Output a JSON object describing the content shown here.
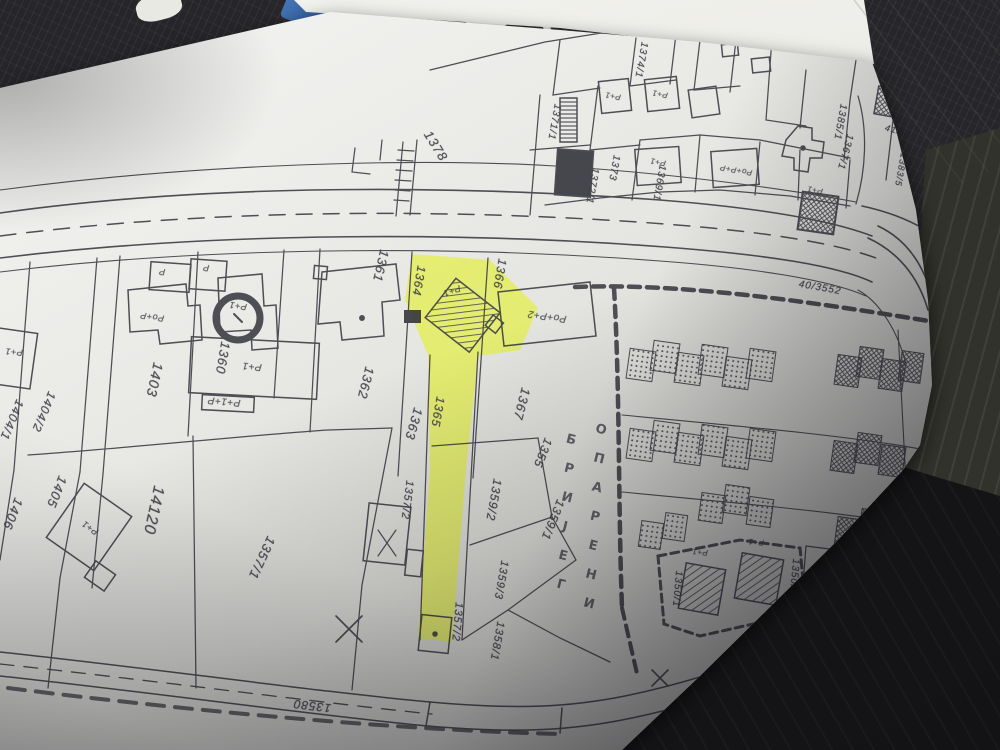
{
  "scene": {
    "colors": {
      "desk": "#26262a",
      "desk_shadow": "#141416",
      "desk_side": "#31322c",
      "paper": "#e9e9e6",
      "ink": "#3d3d45",
      "highlight_yellow": "#e4ee55",
      "pen_blue": "#4577b8",
      "paper_stack_beige": "#e0dbc9"
    }
  },
  "map": {
    "locality": {
      "name": "ОПАРЕНИ БРИЈЕГ",
      "columns": [
        {
          "letters": [
            "О",
            "П",
            "А",
            "Р",
            "Е",
            "Н",
            "И"
          ],
          "x": 601,
          "y": 430,
          "dx": -2,
          "dy": 29,
          "r": 14
        },
        {
          "letters": [
            "Б",
            "Р",
            "И",
            "Ј",
            "Е",
            "Г"
          ],
          "x": 571,
          "y": 440,
          "dx": -2,
          "dy": 29,
          "r": 14
        }
      ]
    },
    "road_labels": [
      {
        "t": "1378",
        "x": 436,
        "y": 146,
        "r": 58,
        "s": 13
      },
      {
        "t": "40/3552",
        "x": 820,
        "y": 288,
        "r": 10,
        "s": 10
      },
      {
        "t": "13580",
        "x": 312,
        "y": 706,
        "r": 187,
        "s": 12
      }
    ],
    "parcel_labels": [
      {
        "t": "1361",
        "x": 381,
        "y": 266,
        "r": 103,
        "s": 13
      },
      {
        "t": "1362",
        "x": 366,
        "y": 383,
        "r": 104,
        "s": 13
      },
      {
        "t": "1363",
        "x": 414,
        "y": 424,
        "r": 106,
        "s": 13
      },
      {
        "t": "1364",
        "x": 419,
        "y": 281,
        "r": 100,
        "s": 12
      },
      {
        "t": "1365",
        "x": 438,
        "y": 412,
        "r": 100,
        "s": 12
      },
      {
        "t": "1366",
        "x": 500,
        "y": 274,
        "r": 100,
        "s": 12
      },
      {
        "t": "1367",
        "x": 522,
        "y": 404,
        "r": 105,
        "s": 13
      },
      {
        "t": "1355",
        "x": 543,
        "y": 453,
        "r": 112,
        "s": 12
      },
      {
        "t": "1360",
        "x": 223,
        "y": 358,
        "r": 100,
        "s": 13
      },
      {
        "t": "1403",
        "x": 155,
        "y": 380,
        "r": 102,
        "s": 14
      },
      {
        "t": "1404/2",
        "x": 44,
        "y": 412,
        "r": 113,
        "s": 12
      },
      {
        "t": "1404/1",
        "x": 12,
        "y": 420,
        "r": 113,
        "s": 12
      },
      {
        "t": "1405",
        "x": 57,
        "y": 492,
        "r": 112,
        "s": 13
      },
      {
        "t": "1406",
        "x": 13,
        "y": 514,
        "r": 112,
        "s": 13
      },
      {
        "t": "14120",
        "x": 153,
        "y": 510,
        "r": 102,
        "s": 16
      },
      {
        "t": "1357/1",
        "x": 262,
        "y": 558,
        "r": 115,
        "s": 13
      },
      {
        "t": "1357/2",
        "x": 407,
        "y": 500,
        "r": 97,
        "s": 11
      },
      {
        "t": "1357/2",
        "x": 457,
        "y": 622,
        "r": 95,
        "s": 11
      },
      {
        "t": "1359/2",
        "x": 494,
        "y": 500,
        "r": 100,
        "s": 12
      },
      {
        "t": "1359/3",
        "x": 501,
        "y": 580,
        "r": 100,
        "s": 11
      },
      {
        "t": "1358/1",
        "x": 497,
        "y": 641,
        "r": 100,
        "s": 11
      },
      {
        "t": "1359/1",
        "x": 553,
        "y": 520,
        "r": 112,
        "s": 12
      },
      {
        "t": "1350/1",
        "x": 677,
        "y": 589,
        "r": 95,
        "s": 10
      },
      {
        "t": "1350/2",
        "x": 794,
        "y": 577,
        "r": 95,
        "s": 10
      },
      {
        "t": "1368",
        "x": 866,
        "y": 574,
        "r": 95,
        "s": 11
      },
      {
        "t": "1371/1",
        "x": 554,
        "y": 122,
        "r": 100,
        "s": 10
      },
      {
        "t": "1372/1",
        "x": 592,
        "y": 186,
        "r": 100,
        "s": 10
      },
      {
        "t": "1373",
        "x": 614,
        "y": 168,
        "r": 100,
        "s": 10
      },
      {
        "t": "1374/1",
        "x": 641,
        "y": 60,
        "r": 100,
        "s": 10
      },
      {
        "t": "1369/1",
        "x": 659,
        "y": 183,
        "r": 100,
        "s": 10
      },
      {
        "t": "1367/1",
        "x": 845,
        "y": 152,
        "r": 105,
        "s": 10
      },
      {
        "t": "1385/1",
        "x": 840,
        "y": 122,
        "r": 100,
        "s": 10
      },
      {
        "t": "41/281/1",
        "x": 906,
        "y": 133,
        "r": 15,
        "s": 9
      },
      {
        "t": "1383/5",
        "x": 901,
        "y": 170,
        "r": 100,
        "s": 9
      }
    ],
    "building_labels": [
      {
        "t": "P",
        "x": 162,
        "y": 272,
        "r": 185,
        "s": 9
      },
      {
        "t": "P",
        "x": 206,
        "y": 268,
        "r": 185,
        "s": 9
      },
      {
        "t": "Po+P",
        "x": 152,
        "y": 317,
        "r": 188,
        "s": 9
      },
      {
        "t": "P+1",
        "x": 238,
        "y": 306,
        "r": 188,
        "s": 9
      },
      {
        "t": "P+1",
        "x": 252,
        "y": 366,
        "r": 185,
        "s": 10
      },
      {
        "t": "P+1+P",
        "x": 224,
        "y": 401,
        "r": 185,
        "s": 10
      },
      {
        "t": "P+1",
        "x": 14,
        "y": 352,
        "r": 185,
        "s": 9
      },
      {
        "t": "P+1",
        "x": 90,
        "y": 528,
        "r": 215,
        "s": 9
      },
      {
        "t": "P+1",
        "x": 452,
        "y": 291,
        "r": 160,
        "s": 9
      },
      {
        "t": "Po+P+2",
        "x": 547,
        "y": 316,
        "r": 188,
        "s": 10
      },
      {
        "t": "P+1",
        "x": 613,
        "y": 96,
        "r": 190,
        "s": 8
      },
      {
        "t": "P+1",
        "x": 660,
        "y": 94,
        "r": 190,
        "s": 8
      },
      {
        "t": "P+1",
        "x": 658,
        "y": 162,
        "r": 190,
        "s": 8
      },
      {
        "t": "Po+P+P",
        "x": 736,
        "y": 170,
        "r": 190,
        "s": 8
      },
      {
        "t": "P+1",
        "x": 815,
        "y": 190,
        "r": 190,
        "s": 8
      },
      {
        "t": "P+1",
        "x": 700,
        "y": 552,
        "r": 185,
        "s": 8
      },
      {
        "t": "P+1",
        "x": 756,
        "y": 542,
        "r": 185,
        "s": 8
      }
    ]
  }
}
